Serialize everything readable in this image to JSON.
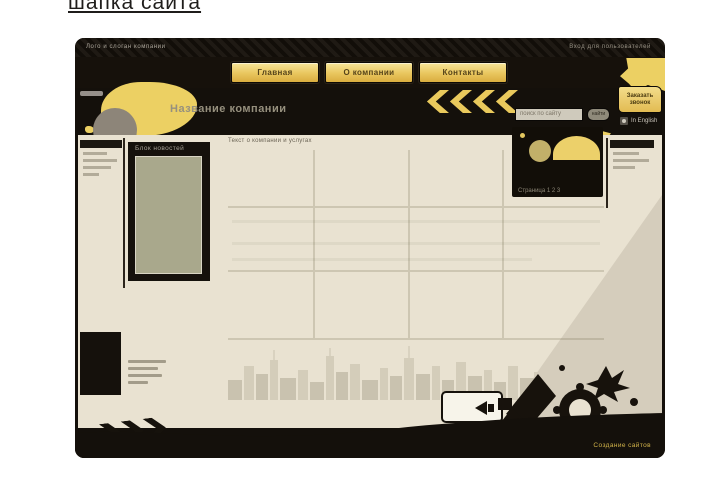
{
  "page": {
    "annotation": "шапка сайта"
  },
  "topbar": {
    "left_text": "Лого и слоган компании",
    "right_text": "Вход для пользователей"
  },
  "nav": {
    "items": [
      {
        "label": "Главная"
      },
      {
        "label": "О компании"
      },
      {
        "label": "Контакты"
      }
    ]
  },
  "header": {
    "company_name": "Название компании",
    "search": {
      "value": "поиск по сайту",
      "button_label": "найти"
    },
    "badge": {
      "line1": "Заказать",
      "line2": "звонок"
    },
    "language_link": "In English"
  },
  "sidebar": {
    "menu_title": "Блок новостей"
  },
  "content": {
    "intro": "Текст о компании и услугах",
    "banner_pager": "Страница 1 2 3"
  },
  "footer": {
    "credit": "Создание сайтов"
  },
  "icons": {
    "top_chevrons": "chevron-left-icon",
    "bottom_chevrons": "chevron-right-icon",
    "back_button": "back-arrow-icon",
    "language": "globe-icon",
    "decor": "gear-splat-icon"
  },
  "colors": {
    "accent_gold": "#ecd063",
    "dark": "#14100b",
    "beige": "#e9e2d1",
    "sage_panel": "#a9a88c",
    "credit_gold": "#d3b44a"
  }
}
